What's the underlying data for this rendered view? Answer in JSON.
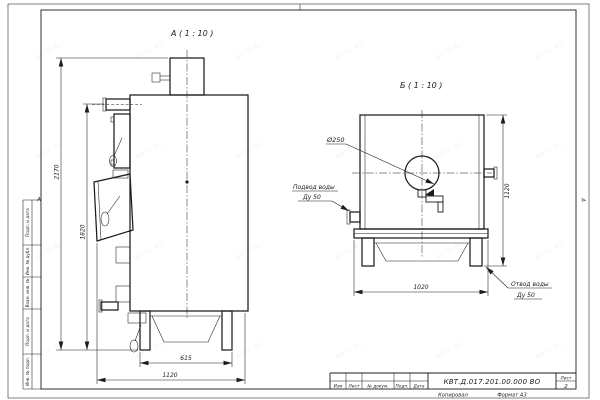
{
  "watermark": "KVTC.RU",
  "views": {
    "a": {
      "label": "А ( 1 : 10 )"
    },
    "b": {
      "label": "Б ( 1 : 10 )"
    }
  },
  "dimensions": {
    "total_height": "2170",
    "body_height": "1820",
    "stand_width": "615",
    "depth": "1120",
    "front_width": "1020",
    "front_height": "1120",
    "flue_diameter": "Ø250"
  },
  "callouts": {
    "inlet_title": "Подвод воды",
    "inlet_size": "Ду 50",
    "outlet_title": "Отвод воды",
    "outlet_size": "Ду 50"
  },
  "margin_stamps": [
    "Подп. и дата",
    "Инв. № дубл.",
    "Взам. инв. №",
    "Подп. и дата",
    "Инв. № подл."
  ],
  "zone_marker": "А",
  "title_block": {
    "doc_number": "КВТ.Д.017.201.00.000 ВО",
    "columns": {
      "izm": "Изм",
      "list": "Лист",
      "doc": "№ докум.",
      "sign": "Подп.",
      "date": "Дата"
    },
    "sheet_label": "Лист",
    "sheet_number": "2",
    "copied_label": "Копировал",
    "format_label": "Формат А3"
  }
}
